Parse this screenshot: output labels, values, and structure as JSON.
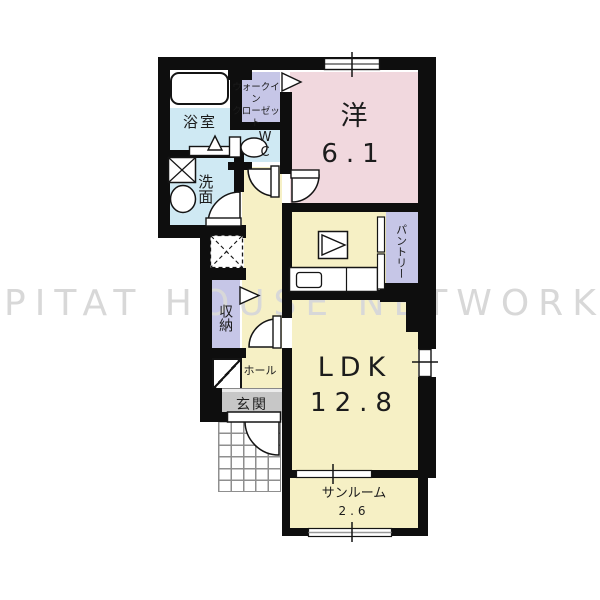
{
  "watermark": "PITAT HOUSE NETWORK",
  "rooms": {
    "bathroom": {
      "label": "浴室"
    },
    "washroom": {
      "label": "洗面"
    },
    "walk_in_closet": {
      "line1": "ウォークイン",
      "line2": "クローゼット"
    },
    "wc": {
      "line1": "W",
      "line2": "C"
    },
    "western_room": {
      "label": "洋",
      "size": "6.1"
    },
    "pantry": {
      "label": "パントリー"
    },
    "storage": {
      "label": "収納"
    },
    "hall": {
      "label": "ホール"
    },
    "entrance": {
      "label": "玄関"
    },
    "ldk": {
      "label": "LDK",
      "size": "12.8"
    },
    "sunroom": {
      "label": "サンルーム",
      "size": "2.6"
    }
  },
  "colors": {
    "wall": "#0e0e0e",
    "room_pink": "#f1d8de",
    "room_yellow": "#f6f0c5",
    "room_lavender": "#c6c6e7",
    "room_blue": "#cfe9f3",
    "entrance_gray": "#c7c7c7",
    "watermark_gray": "#d8d8d8"
  }
}
